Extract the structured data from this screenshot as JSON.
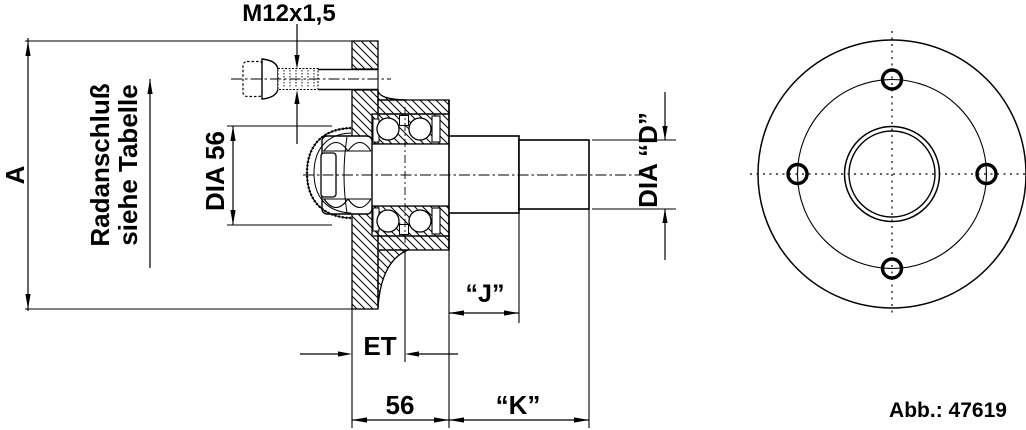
{
  "labels": {
    "thread_size": "M12x1,5",
    "wheel_mount_line1": "Radanschluß",
    "wheel_mount_line2": "siehe Tabelle",
    "flange_diameter": "A",
    "cap_diameter": "DIA 56",
    "shaft_diameter": "DIA “D”",
    "seat_length": "“J”",
    "offset": "ET",
    "hub_width": "56",
    "shaft_length": "“K”",
    "figure_number": "Abb.: 47619"
  },
  "colors": {
    "line": "#000000",
    "background": "#ffffff"
  }
}
